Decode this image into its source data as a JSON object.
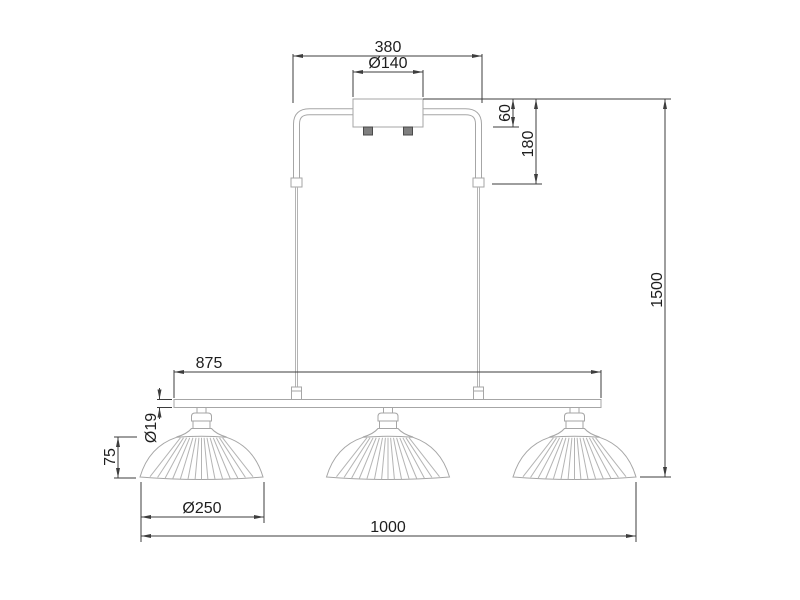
{
  "drawing": {
    "dimensions": {
      "top_width": "380",
      "canopy_diameter": "Ø140",
      "canopy_height": "60",
      "suspension_drop": "180",
      "total_height": "1500",
      "bar_length": "875",
      "bar_diameter": "Ø19",
      "shade_height": "75",
      "shade_diameter": "Ø250",
      "total_width": "1000"
    },
    "colors": {
      "dimension_line": "#3d3d3d",
      "dimension_text": "#1e1e1e",
      "fixture_line": "#a6a6a6",
      "background": "#ffffff"
    }
  }
}
